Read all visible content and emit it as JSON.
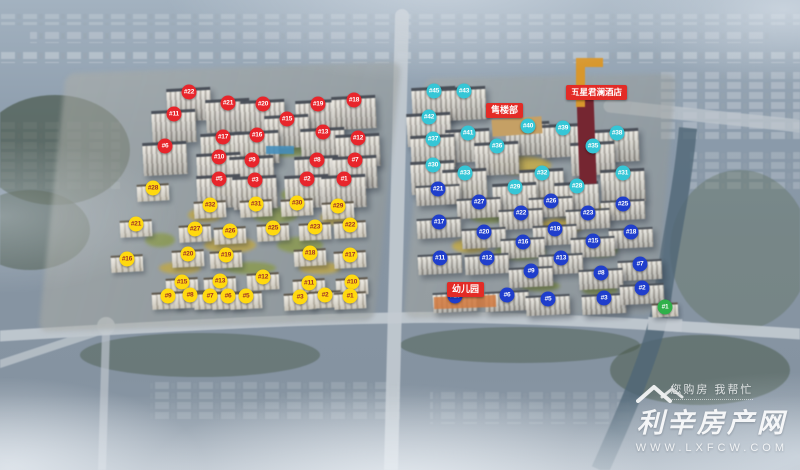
{
  "labels": {
    "sales_office": "售楼部",
    "hotel": "五星君澜酒店",
    "kindergarten": "幼儿园"
  },
  "watermark": {
    "icon": "house-roof-icon",
    "tagline": "您购房 我帮忙",
    "site_name": "利辛房产网",
    "url": "WWW.LXFCW.COM"
  },
  "badge_groups": [
    {
      "name": "west_highrise",
      "color": "#e8252b",
      "text_color": "#ffffff",
      "badges": [
        {
          "label": "#22",
          "x": 189,
          "y": 92
        },
        {
          "label": "#21",
          "x": 228,
          "y": 103
        },
        {
          "label": "#20",
          "x": 263,
          "y": 104
        },
        {
          "label": "#19",
          "x": 318,
          "y": 104
        },
        {
          "label": "#18",
          "x": 354,
          "y": 100
        },
        {
          "label": "#11",
          "x": 174,
          "y": 114
        },
        {
          "label": "#15",
          "x": 287,
          "y": 119
        },
        {
          "label": "#17",
          "x": 223,
          "y": 137
        },
        {
          "label": "#16",
          "x": 257,
          "y": 135
        },
        {
          "label": "#13",
          "x": 323,
          "y": 132
        },
        {
          "label": "#12",
          "x": 358,
          "y": 138
        },
        {
          "label": "#6",
          "x": 165,
          "y": 146
        },
        {
          "label": "#10",
          "x": 219,
          "y": 157
        },
        {
          "label": "#9",
          "x": 252,
          "y": 160
        },
        {
          "label": "#8",
          "x": 317,
          "y": 160
        },
        {
          "label": "#7",
          "x": 355,
          "y": 160
        },
        {
          "label": "#5",
          "x": 219,
          "y": 179
        },
        {
          "label": "#3",
          "x": 255,
          "y": 180
        },
        {
          "label": "#2",
          "x": 307,
          "y": 179
        },
        {
          "label": "#1",
          "x": 344,
          "y": 179
        }
      ]
    },
    {
      "name": "west_lowrise",
      "color": "#ffd90f",
      "text_color": "#a03028",
      "badges": [
        {
          "label": "#28",
          "x": 153,
          "y": 188
        },
        {
          "label": "#32",
          "x": 210,
          "y": 205
        },
        {
          "label": "#31",
          "x": 256,
          "y": 204
        },
        {
          "label": "#30",
          "x": 297,
          "y": 203
        },
        {
          "label": "#29",
          "x": 338,
          "y": 206
        },
        {
          "label": "#21",
          "x": 136,
          "y": 224
        },
        {
          "label": "#27",
          "x": 195,
          "y": 229
        },
        {
          "label": "#26",
          "x": 230,
          "y": 231
        },
        {
          "label": "#25",
          "x": 273,
          "y": 228
        },
        {
          "label": "#23",
          "x": 315,
          "y": 227
        },
        {
          "label": "#22",
          "x": 350,
          "y": 225
        },
        {
          "label": "#16",
          "x": 127,
          "y": 259
        },
        {
          "label": "#20",
          "x": 188,
          "y": 254
        },
        {
          "label": "#19",
          "x": 226,
          "y": 255
        },
        {
          "label": "#18",
          "x": 310,
          "y": 253
        },
        {
          "label": "#17",
          "x": 350,
          "y": 255
        },
        {
          "label": "#15",
          "x": 182,
          "y": 282
        },
        {
          "label": "#13",
          "x": 220,
          "y": 281
        },
        {
          "label": "#12",
          "x": 263,
          "y": 277
        },
        {
          "label": "#11",
          "x": 309,
          "y": 283
        },
        {
          "label": "#10",
          "x": 352,
          "y": 282
        },
        {
          "label": "#9",
          "x": 168,
          "y": 296
        },
        {
          "label": "#8",
          "x": 190,
          "y": 295
        },
        {
          "label": "#7",
          "x": 210,
          "y": 296
        },
        {
          "label": "#6",
          "x": 228,
          "y": 296
        },
        {
          "label": "#5",
          "x": 246,
          "y": 296
        },
        {
          "label": "#3",
          "x": 300,
          "y": 297
        },
        {
          "label": "#2",
          "x": 325,
          "y": 295
        },
        {
          "label": "#1",
          "x": 350,
          "y": 296
        }
      ]
    },
    {
      "name": "east_north",
      "color": "#35c6d6",
      "text_color": "#ffffff",
      "badges": [
        {
          "label": "#45",
          "x": 434,
          "y": 91
        },
        {
          "label": "#43",
          "x": 464,
          "y": 91
        },
        {
          "label": "#42",
          "x": 429,
          "y": 117
        },
        {
          "label": "#41",
          "x": 468,
          "y": 133
        },
        {
          "label": "#40",
          "x": 528,
          "y": 126
        },
        {
          "label": "#39",
          "x": 563,
          "y": 128
        },
        {
          "label": "#38",
          "x": 617,
          "y": 133
        },
        {
          "label": "#37",
          "x": 433,
          "y": 139
        },
        {
          "label": "#36",
          "x": 497,
          "y": 146
        },
        {
          "label": "#35",
          "x": 593,
          "y": 146
        },
        {
          "label": "#30",
          "x": 433,
          "y": 165
        },
        {
          "label": "#33",
          "x": 465,
          "y": 173
        },
        {
          "label": "#32",
          "x": 542,
          "y": 173
        },
        {
          "label": "#31",
          "x": 623,
          "y": 173
        },
        {
          "label": "#29",
          "x": 515,
          "y": 187
        },
        {
          "label": "#28",
          "x": 577,
          "y": 186
        }
      ]
    },
    {
      "name": "east_south",
      "color": "#1f3ecc",
      "text_color": "#ffffff",
      "badges": [
        {
          "label": "#21",
          "x": 438,
          "y": 189
        },
        {
          "label": "#27",
          "x": 479,
          "y": 202
        },
        {
          "label": "#26",
          "x": 551,
          "y": 201
        },
        {
          "label": "#25",
          "x": 623,
          "y": 204
        },
        {
          "label": "#17",
          "x": 439,
          "y": 222
        },
        {
          "label": "#22",
          "x": 521,
          "y": 213
        },
        {
          "label": "#23",
          "x": 588,
          "y": 213
        },
        {
          "label": "#20",
          "x": 484,
          "y": 232
        },
        {
          "label": "#19",
          "x": 555,
          "y": 229
        },
        {
          "label": "#18",
          "x": 631,
          "y": 232
        },
        {
          "label": "#16",
          "x": 523,
          "y": 242
        },
        {
          "label": "#15",
          "x": 593,
          "y": 241
        },
        {
          "label": "#11",
          "x": 440,
          "y": 258
        },
        {
          "label": "#12",
          "x": 487,
          "y": 258
        },
        {
          "label": "#13",
          "x": 561,
          "y": 258
        },
        {
          "label": "#7",
          "x": 640,
          "y": 264
        },
        {
          "label": "#9",
          "x": 531,
          "y": 271
        },
        {
          "label": "#8",
          "x": 601,
          "y": 273
        },
        {
          "label": "#10",
          "x": 455,
          "y": 296
        },
        {
          "label": "#6",
          "x": 507,
          "y": 295
        },
        {
          "label": "#5",
          "x": 548,
          "y": 299
        },
        {
          "label": "#3",
          "x": 604,
          "y": 298
        },
        {
          "label": "#2",
          "x": 642,
          "y": 288
        }
      ]
    },
    {
      "name": "east_green",
      "color": "#2fb04a",
      "text_color": "#ffffff",
      "badges": [
        {
          "label": "#1",
          "x": 665,
          "y": 307
        }
      ]
    }
  ]
}
